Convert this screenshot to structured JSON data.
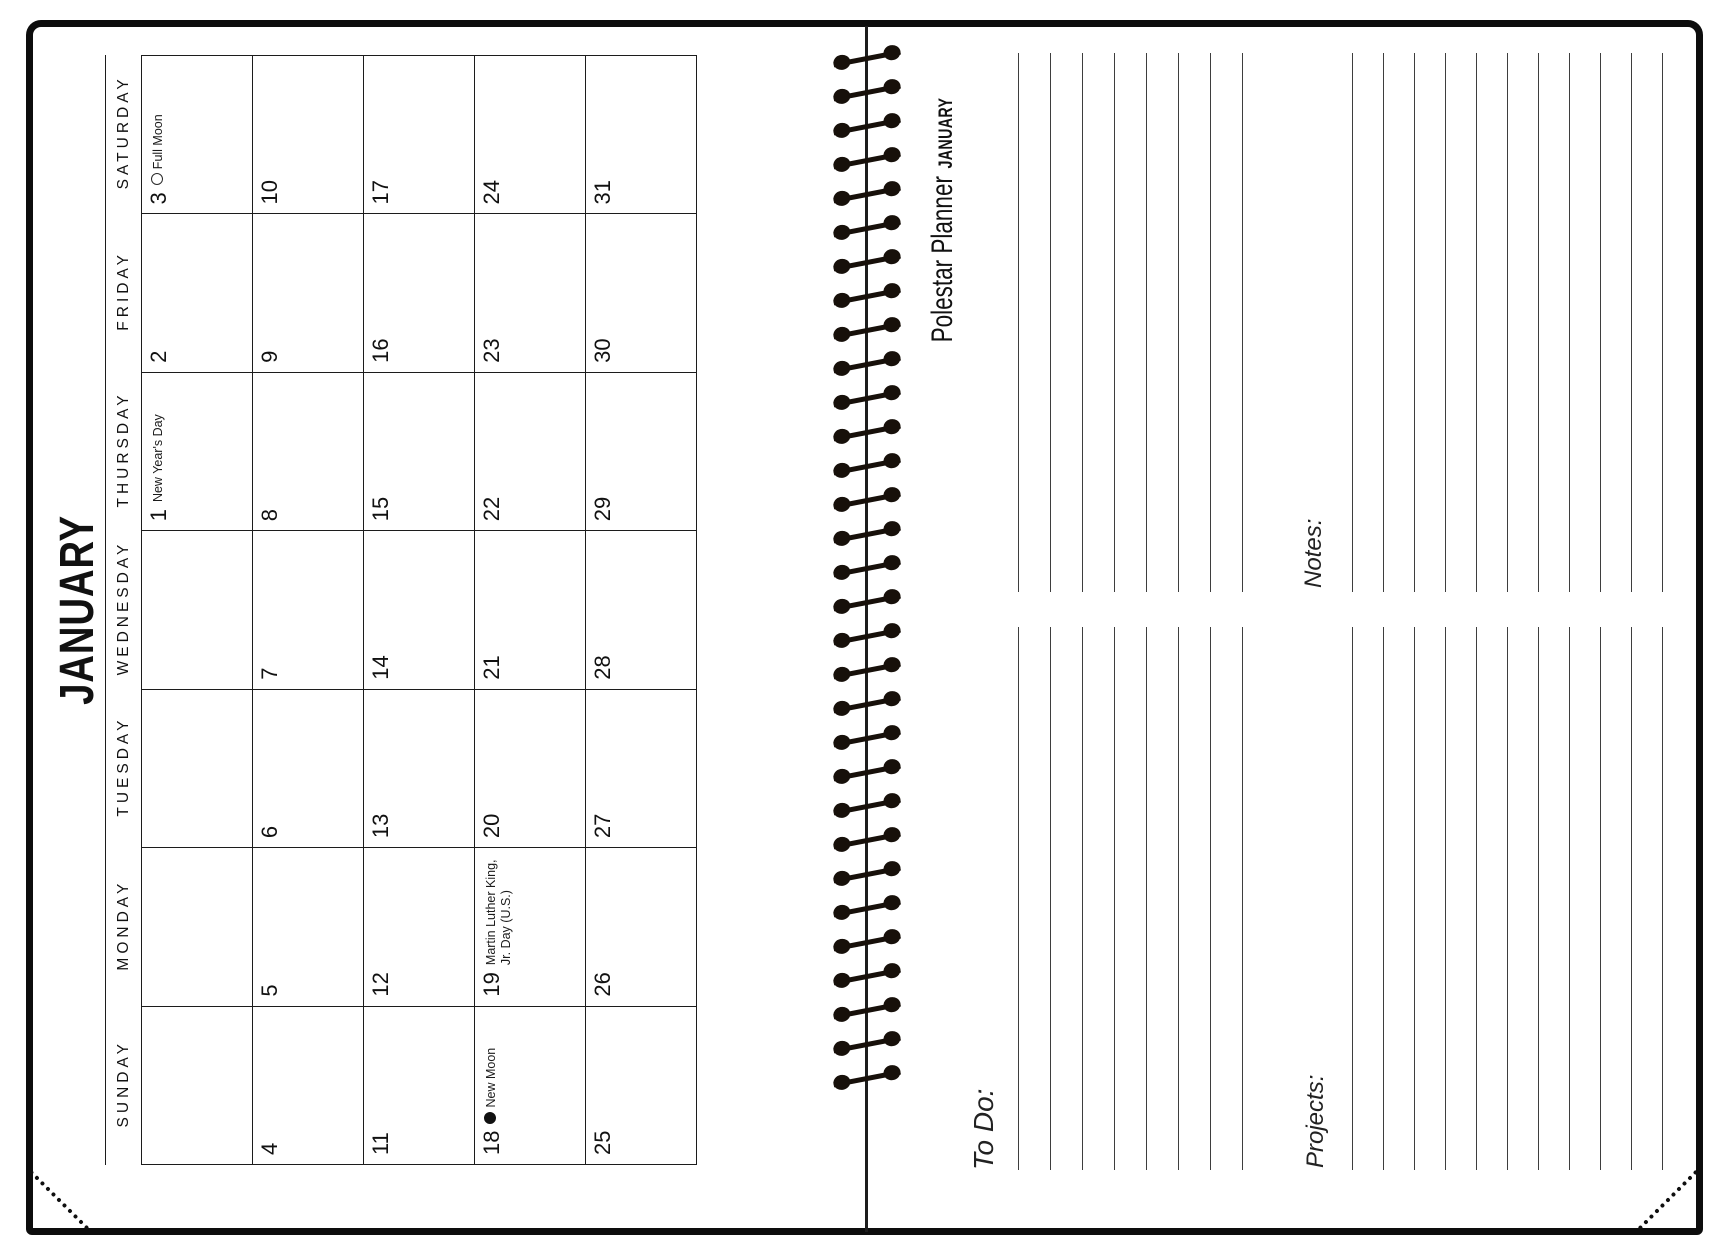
{
  "calendar_page": {
    "month_title": "JANUARY",
    "day_headers": [
      "SUNDAY",
      "MONDAY",
      "TUESDAY",
      "WEDNESDAY",
      "THURSDAY",
      "FRIDAY",
      "SATURDAY"
    ],
    "weeks": [
      [
        {
          "date": ""
        },
        {
          "date": ""
        },
        {
          "date": ""
        },
        {
          "date": ""
        },
        {
          "date": "1",
          "event": "New Year's Day"
        },
        {
          "date": "2"
        },
        {
          "date": "3",
          "event": "Full Moon",
          "moon": "full"
        }
      ],
      [
        {
          "date": "4"
        },
        {
          "date": "5"
        },
        {
          "date": "6"
        },
        {
          "date": "7"
        },
        {
          "date": "8"
        },
        {
          "date": "9"
        },
        {
          "date": "10"
        }
      ],
      [
        {
          "date": "11"
        },
        {
          "date": "12"
        },
        {
          "date": "13"
        },
        {
          "date": "14"
        },
        {
          "date": "15"
        },
        {
          "date": "16"
        },
        {
          "date": "17"
        }
      ],
      [
        {
          "date": "18",
          "event": "New Moon",
          "moon": "new"
        },
        {
          "date": "19",
          "event": "Martin Luther King, Jr. Day (U.S.)"
        },
        {
          "date": "20"
        },
        {
          "date": "21"
        },
        {
          "date": "22"
        },
        {
          "date": "23"
        },
        {
          "date": "24"
        }
      ],
      [
        {
          "date": "25"
        },
        {
          "date": "26"
        },
        {
          "date": "27"
        },
        {
          "date": "28"
        },
        {
          "date": "29"
        },
        {
          "date": "30"
        },
        {
          "date": "31"
        }
      ]
    ]
  },
  "notes_page": {
    "brand": "Polestar Planner",
    "month_label": "JANUARY",
    "todo_label": "To Do:",
    "projects_label": "Projects:",
    "notes_label": "Notes:"
  },
  "icons": {
    "full_moon": "open-circle",
    "new_moon": "filled-circle"
  },
  "colors": {
    "ink": "#111111",
    "grid_line": "#1c1c1c",
    "ruled_line": "#3e3e3e"
  }
}
